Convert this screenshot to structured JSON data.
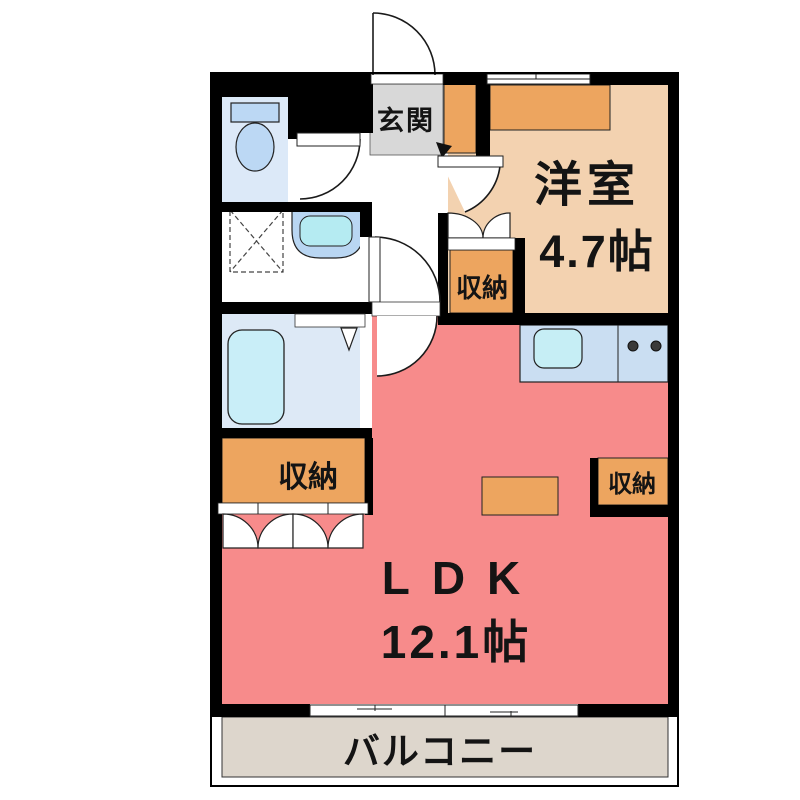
{
  "floor_plan": {
    "entrance": {
      "label": "玄関"
    },
    "western_room": {
      "label": "洋室",
      "size": "4.7帖"
    },
    "ldk": {
      "label": "LDK",
      "size": "12.1帖"
    },
    "balcony": {
      "label": "バルコニー"
    },
    "closets": {
      "hall": "収納",
      "west": "収納",
      "kitchen_side": "収納"
    },
    "colors": {
      "wall": "#000000",
      "ldk_floor": "#f78b8b",
      "western_room_floor": "#f3d2b0",
      "closet_orange": "#eda55f",
      "entrance_floor": "#d8d8d8",
      "balcony_floor": "#ddd6cc",
      "toilet_room_floor": "#dce9f8",
      "bathroom_floor": "#dde9f6",
      "kitchen_counter": "#cadef2",
      "fixture_blue": "#bcd8f4",
      "water_cyan": "#c6eef5"
    }
  }
}
